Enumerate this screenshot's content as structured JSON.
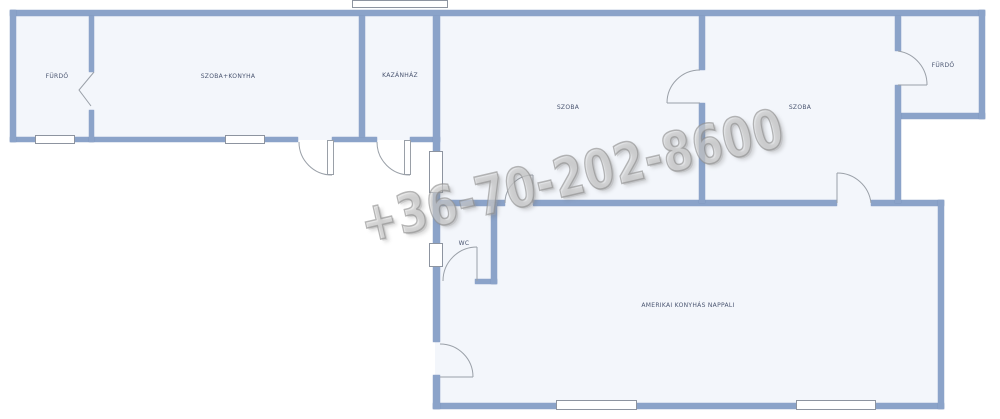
{
  "plan": {
    "type": "floor-plan",
    "language": "hu"
  },
  "watermark": {
    "text": "+36-70-202-8600"
  },
  "rooms": [
    {
      "id": "furdo-left",
      "label": "FÜRDŐ"
    },
    {
      "id": "szoba-konyha",
      "label": "SZOBA+KONYHA"
    },
    {
      "id": "kazanhaz",
      "label": "KAZÁNHÁZ"
    },
    {
      "id": "szoba-1",
      "label": "SZOBA"
    },
    {
      "id": "szoba-2",
      "label": "SZOBA"
    },
    {
      "id": "furdo-right",
      "label": "FÜRDŐ"
    },
    {
      "id": "wc",
      "label": "WC"
    },
    {
      "id": "nappali",
      "label": "AMERIKAI KONYHÁS NAPPALI"
    }
  ],
  "colors": {
    "wall": "#8ba3c9",
    "wall-edge": "#7188b6",
    "room": "#f3f6fb",
    "outside": "#ffffff",
    "doorline": "#9aa0a8",
    "winb": "#8d94a0",
    "label": "#4a5570"
  }
}
